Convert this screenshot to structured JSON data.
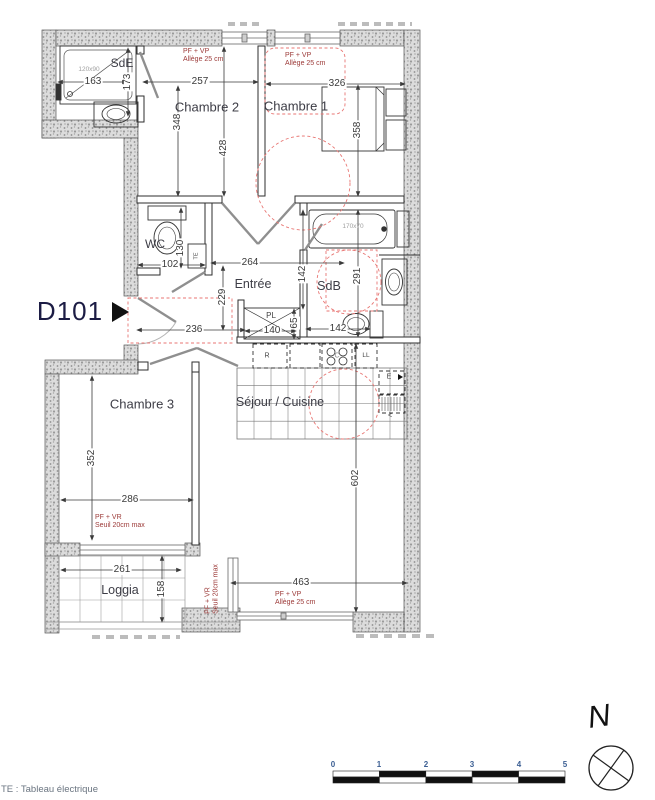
{
  "plan": {
    "id_label": "D101",
    "north_label": "N",
    "legend_te": "TE : Tableau électrique"
  },
  "rooms": {
    "sde": "SdE",
    "chambre2": "Chambre 2",
    "chambre1": "Chambre 1",
    "wc": "WC",
    "entree": "Entrée",
    "sdb": "SdB",
    "chambre3": "Chambre 3",
    "sejour_cuisine": "Séjour / Cuisine",
    "loggia": "Loggia"
  },
  "annotations": {
    "pf_vp_line1": "PF + VP",
    "pf_vp_line2": "Allège 25 cm",
    "pf_vr_line1": "PF + VR",
    "pf_vr_line2": "Seuil 20cm max",
    "shower_size": "120x90",
    "bath_size": "170x70"
  },
  "equipment": {
    "te": "TE",
    "pl": "PL",
    "fridge": "R",
    "cooktop": "C",
    "washer": "LL",
    "sink": "E",
    "arrow": "<"
  },
  "dimensions": {
    "sde_width": "163",
    "sde_height": "173",
    "chambre2_width": "257",
    "chambre2_height": "348",
    "chambre2_total_height": "428",
    "chambre1_width": "326",
    "chambre1_height": "358",
    "wc_width": "102",
    "wc_height": "130",
    "hall_width": "264",
    "hall_height": "229",
    "hall_sdb": "142",
    "sdb_height": "291",
    "sdb_wc_width": "142",
    "entry_width": "236",
    "closet_width": "140",
    "closet_depth": "65",
    "chambre3_height": "352",
    "chambre3_width": "286",
    "loggia_width": "261",
    "loggia_depth": "158",
    "sejour_window": "463",
    "sejour_height": "602"
  },
  "scale_bar": {
    "ticks": [
      "0",
      "1",
      "2",
      "3",
      "4",
      "5"
    ]
  },
  "colors": {
    "annotation_red": "#9c3a38",
    "dashed_red": "#e87673",
    "wall_fill": "#dcdcdc"
  }
}
